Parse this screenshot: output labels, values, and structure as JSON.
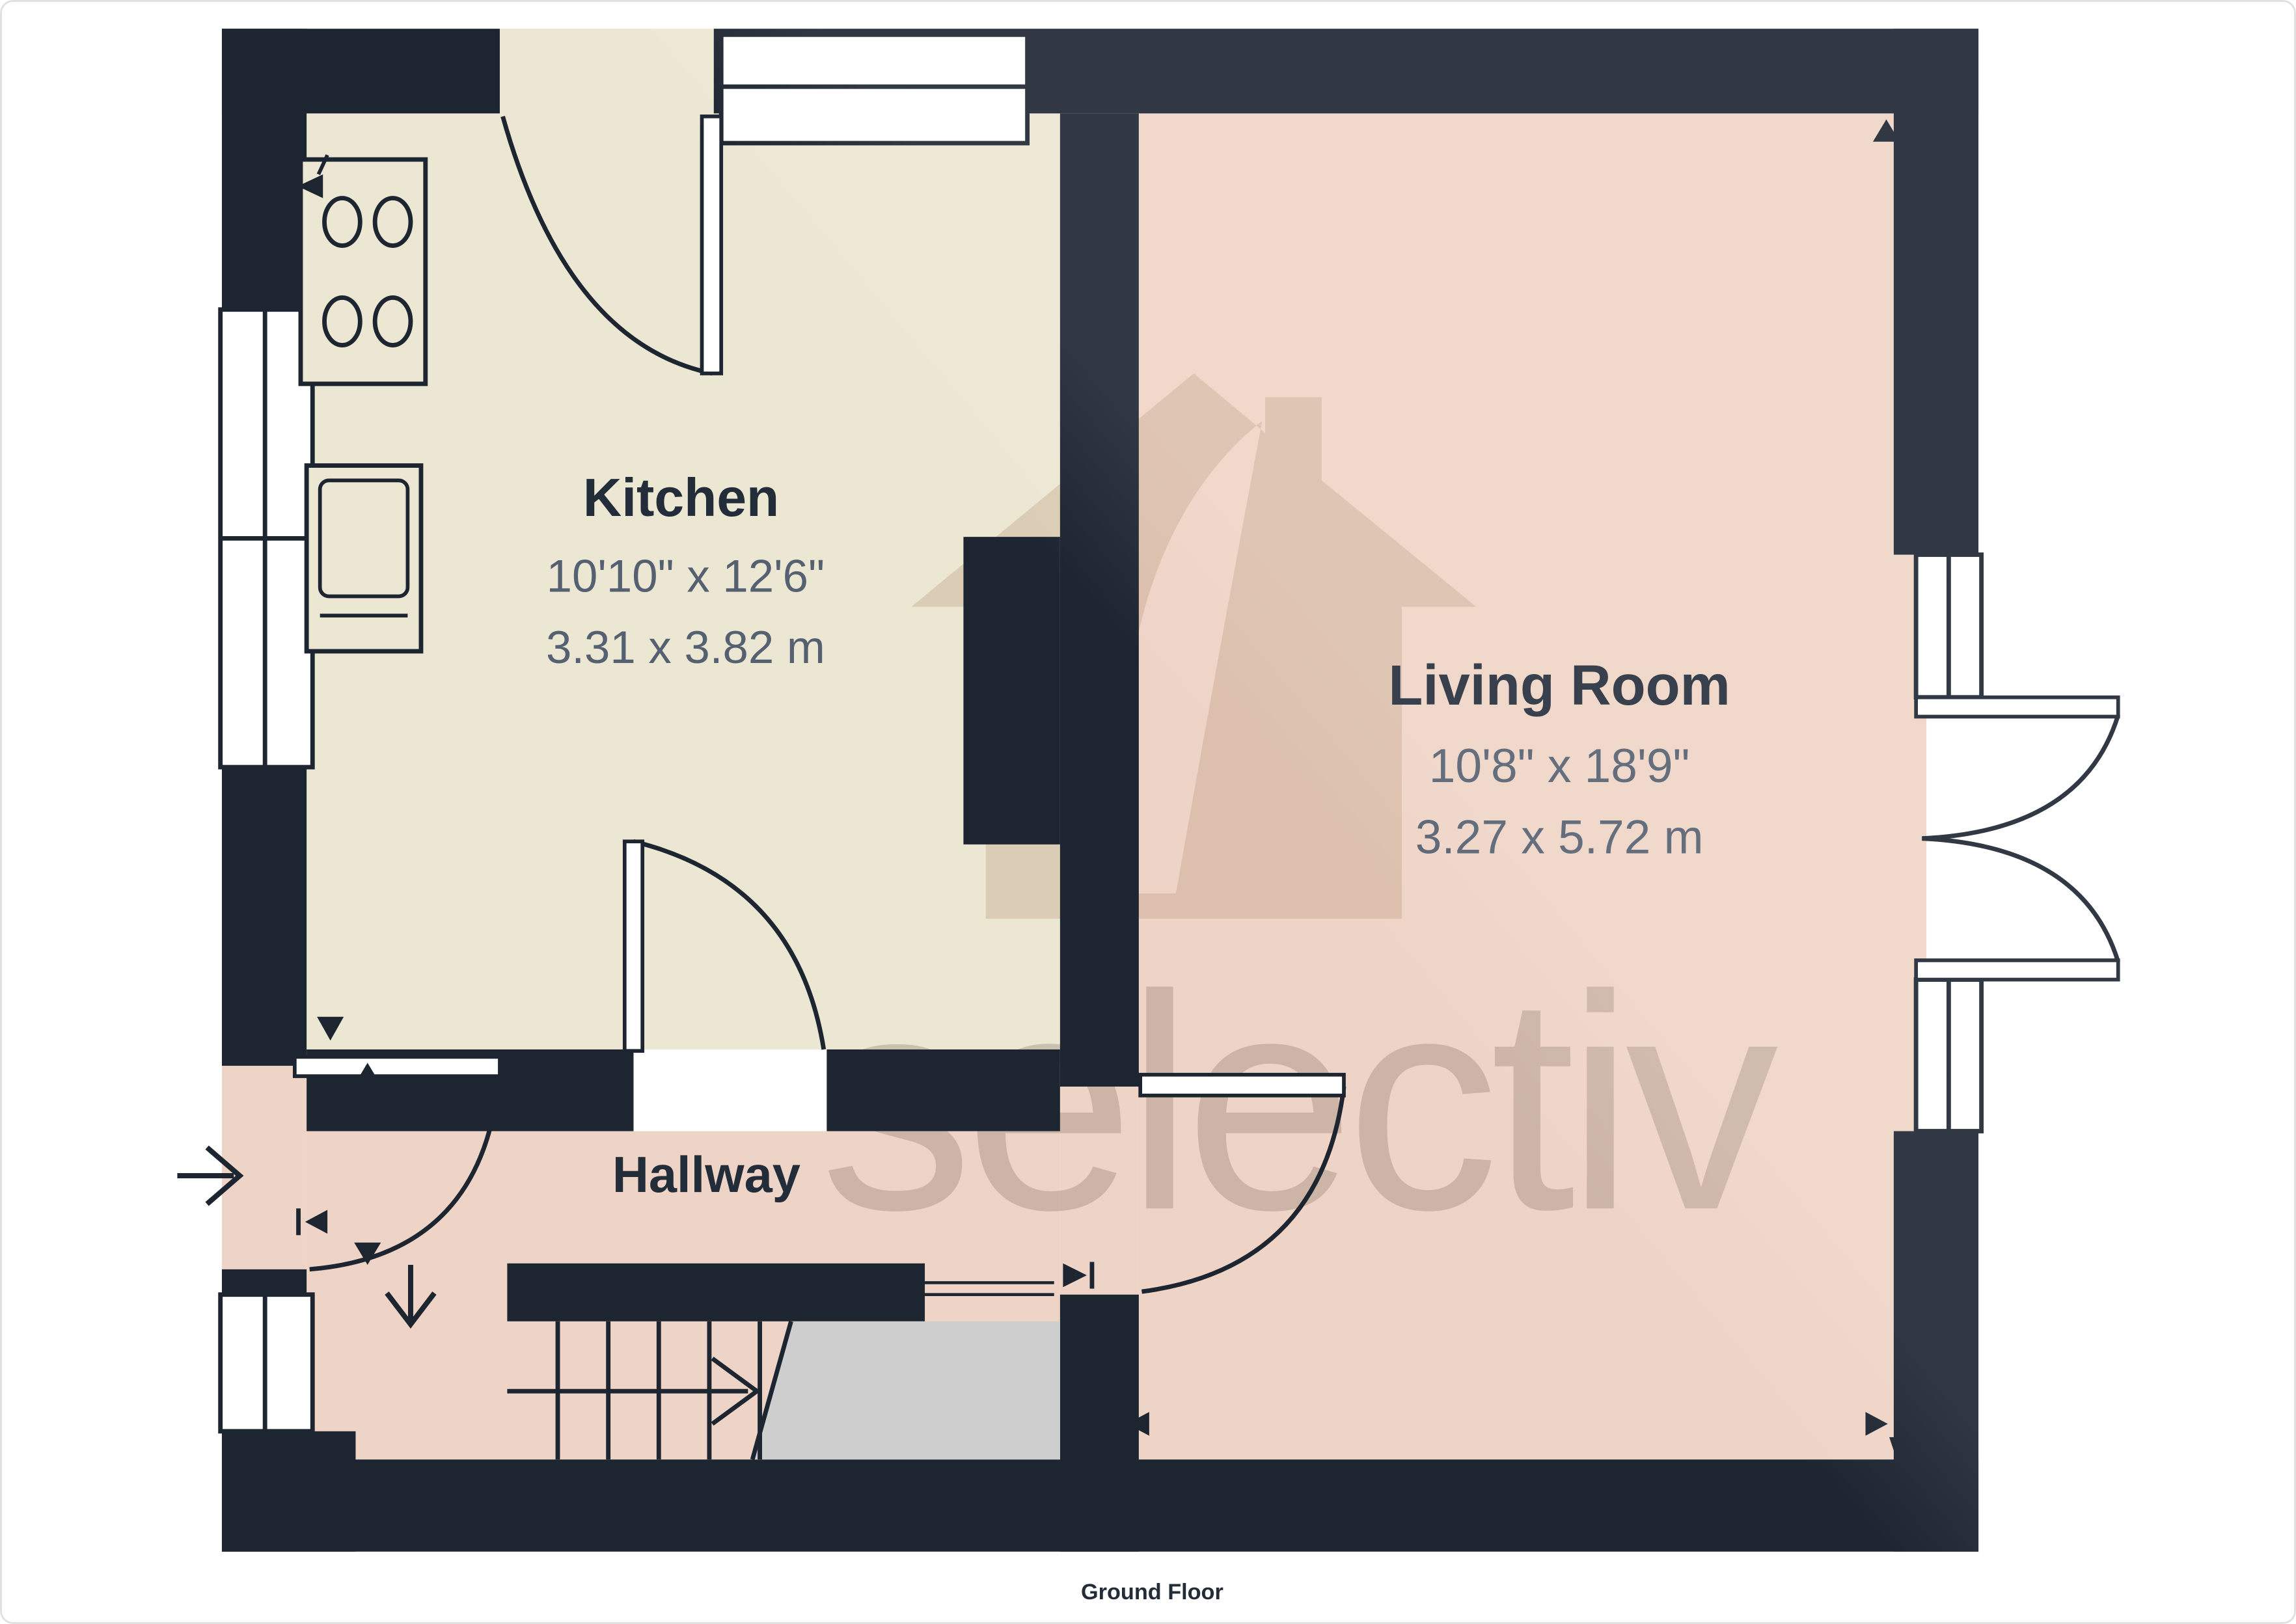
{
  "floor_plan": {
    "floor_label": "Ground Floor",
    "rooms": {
      "kitchen": {
        "name": "Kitchen",
        "dims_imperial": "10'10\" x 12'6\"",
        "dims_metric": "3.31 x 3.82 m"
      },
      "living_room": {
        "name": "Living Room",
        "dims_imperial": "10'8\" x 18'9\"",
        "dims_metric": "3.27 x 5.72 m"
      },
      "hallway": {
        "name": "Hallway"
      }
    },
    "watermark": {
      "text": "selectiv",
      "logo": "house-leaf-logo"
    },
    "icons": {
      "entry_arrow": "right-open-arrow",
      "hall_down_arrow": "down-open-arrow",
      "stairs_direction": "right-chevron",
      "survey_markers": [
        "up-triangle",
        "down-triangle",
        "left-triangle",
        "right-triangle"
      ]
    },
    "colors": {
      "wall": "#1d2531",
      "kitchen_floor": "#ece7d3",
      "living_floor": "#eed4c6",
      "hallway_floor": "#eed4c6",
      "stairs": "#cecece",
      "window": "#ffffff",
      "label_title": "#232d3a",
      "label_dims": "#556070",
      "page_border": "#e0e0e0"
    }
  }
}
